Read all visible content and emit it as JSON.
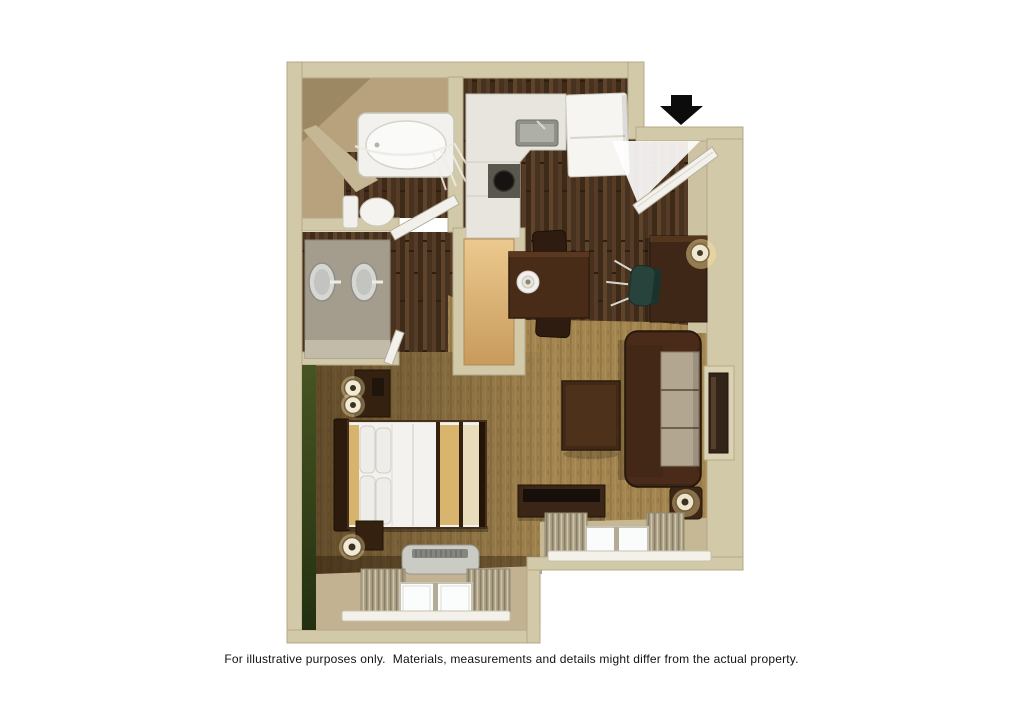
{
  "caption": "For illustrative purposes only.  Materials, measurements and details might differ from the actual property.",
  "floor_plan": {
    "kind": "3d-rendered studio suite floor plan",
    "entry_arrow_icon": "down-arrow-icon",
    "rooms": [
      "entry",
      "kitchen",
      "bathroom",
      "vanity-area",
      "closet",
      "dining-area",
      "living-area",
      "sleeping-area"
    ],
    "furniture": [
      "bathtub",
      "shower-curtain",
      "toilet",
      "double-sink-vanity",
      "kitchen-counter",
      "kitchen-sink",
      "cooktop",
      "refrigerator",
      "entry-door",
      "dining-table",
      "dining-chairs",
      "place-setting",
      "desk",
      "desk-lamp",
      "office-chair",
      "wardrobe-closet",
      "sofa",
      "tv-wall-panel",
      "coffee-table",
      "media-console",
      "side-table-lamp",
      "bed",
      "headboard",
      "pillows",
      "nightstands",
      "table-lamps",
      "ptac-unit",
      "bedroom-window",
      "living-room-window",
      "curtains"
    ],
    "colors": {
      "background": "#ffffff",
      "wall": "#d2c9a8",
      "wood_floor": "#4a3220",
      "carpet_living": "#a1844e",
      "carpet_bedroom_shadow": "#5f4526",
      "accent_wall_green": "#3c4a1d",
      "bed_linen": "#f3f2ef",
      "bed_runner_gold": "#d8b46c",
      "sofa_leather": "#3b2418",
      "sofa_cushions": "#b2a691",
      "furniture_wood": "#3e2717",
      "closet_wood": "#d9ae74",
      "entry_arrow": "#0c0c0c"
    }
  }
}
